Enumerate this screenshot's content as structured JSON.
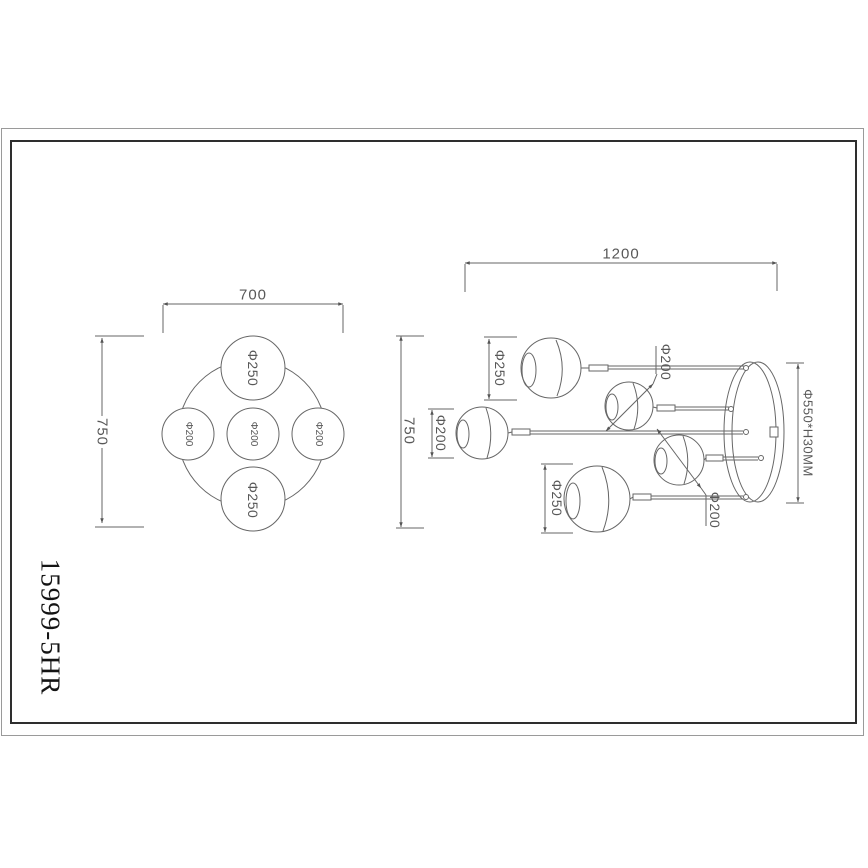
{
  "part_number": "15999-5HR",
  "top_view": {
    "dim_width": "700",
    "dim_height": "750",
    "globe_top": "Φ250",
    "globe_bottom": "Φ250",
    "globe_left": "Φ200",
    "globe_center": "Φ200",
    "globe_right": "Φ200"
  },
  "side_view": {
    "dim_width": "1200",
    "dim_height": "750",
    "dim_globe_top": "Φ250",
    "dim_globe_left": "Φ200",
    "dim_globe_bottom": "Φ250",
    "leader_globe_upper": "Φ200",
    "leader_globe_lower": "Φ200",
    "dim_canopy": "Φ550*H30MM"
  },
  "colors": {
    "line": "#666666",
    "dim_text": "#585858",
    "frame_inner": "#2e2e2e",
    "frame_outer": "#9a9a9a"
  }
}
